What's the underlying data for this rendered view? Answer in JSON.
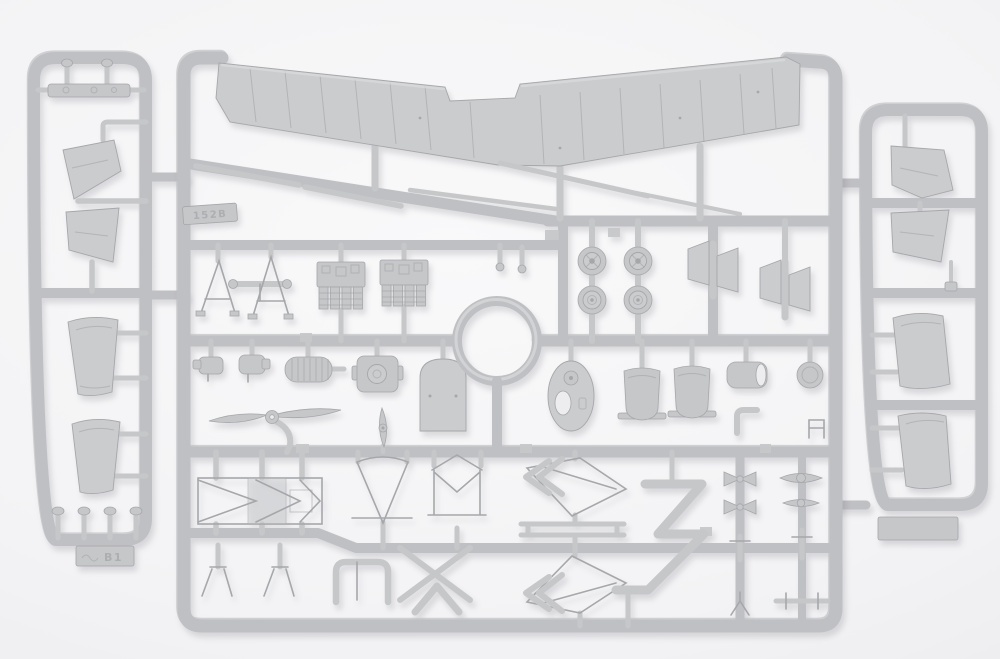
{
  "meta": {
    "type": "photograph",
    "subject": "Light-grey injection-molded plastic model kit sprues with biplane aircraft parts on a white background",
    "sprue_count": 3
  },
  "colors": {
    "background_edge": "#e8e8ea",
    "background_mid": "#f3f3f5",
    "background_center": "#f9f9fa",
    "plastic": "#c6c7c9",
    "plastic_light": "#d2d3d5",
    "plastic_dark": "#a6a7aa",
    "panel": "#cbccce",
    "rail": "#bfc0c3",
    "rail_hi": "#dadbdd",
    "detail_line": "#9fa0a3",
    "emboss_text": "#a9aaad",
    "hole": "#ededef",
    "shadow": "rgba(70,70,80,0.16)"
  },
  "sprues": {
    "left": {
      "name": "left runner with tail panels and wing tip sections",
      "tab_text": "B1",
      "parts": [
        "hinge bar",
        "2 mushroom pins",
        "2 tail fin panels",
        "2 wing tip sections",
        "4 rigging pins",
        "embossed maker tab"
      ]
    },
    "center": {
      "name": "main runner",
      "tab_text": "152B",
      "parts": [
        "one-piece upper wing",
        "2 leading-edge strips",
        "tail skid rod",
        "2 spoked wheels",
        "2 disc wheels",
        "cowling ring",
        "2 strut-and-panel sets",
        "2 cabane A-frames",
        "strut cross bar",
        "2 engine cylinder banks",
        "2 carburetor fittings",
        "ribbed fuel tank",
        "engine crankcase",
        "cowling front panel",
        "fuselage top deck",
        "2 bucket seats",
        "exhaust sleeve",
        "round cap",
        "two-blade propeller",
        "small propeller",
        "fuselage side frame",
        "2 triangular frames",
        "landing-gear vee struts",
        "T bracket",
        "2 kite-shaped wing frames",
        "2 spreader bars",
        "zig-zag exhaust manifold",
        "assorted small fittings"
      ]
    },
    "right": {
      "name": "right runner with tail panels and wing tip sections",
      "tab_text": "",
      "parts": [
        "2 tail fin panels",
        "2 wing tip sections",
        "small pins",
        "blank tab"
      ]
    }
  }
}
